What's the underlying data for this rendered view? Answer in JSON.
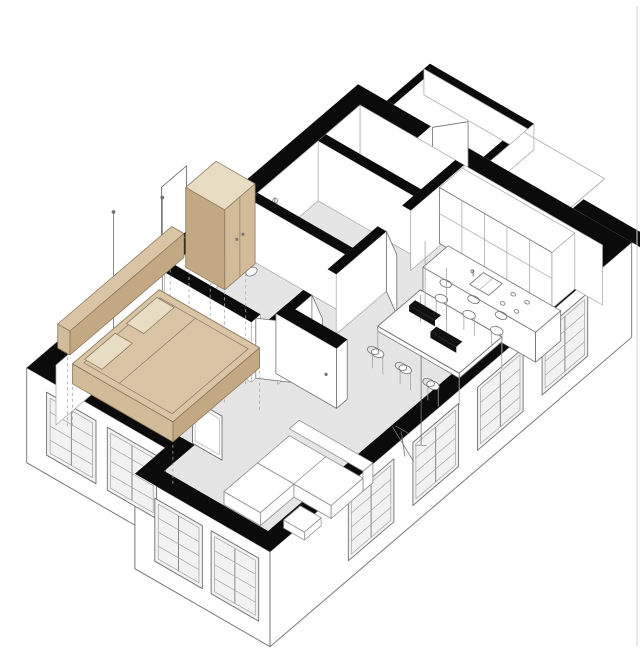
{
  "illustration": {
    "kind": "axonometric-floor-plan",
    "rooms": [
      "entry-hall",
      "bathroom",
      "wc",
      "bedroom",
      "kitchen",
      "dining-area",
      "living-area",
      "stair-annex"
    ],
    "elements": [
      "perimeter-walls",
      "interior-floor",
      "exterior-facades",
      "windows",
      "bed",
      "pillows",
      "headboard-shelf",
      "wardrobe",
      "glass-panel",
      "projection-lines",
      "kitchen-tall-cabinets",
      "kitchen-island",
      "sink",
      "cooktop",
      "faucet",
      "dining-table",
      "dining-chairs",
      "pendant-lights",
      "partition-wall",
      "tv-panel",
      "sofa",
      "coffee-table",
      "floor-lamp",
      "easel",
      "toilet",
      "shower",
      "door-leaves",
      "entrance-door"
    ],
    "dining_chair_count": 6,
    "pendant_count": 2,
    "window_count_se_facade": 4,
    "window_count_sw_facade": 2,
    "window_count_bay": 2
  },
  "colors": {
    "background": "#ffffff",
    "wall": "#0b0b0b",
    "floor": "#e5e5e6",
    "face": "#ffffff",
    "pane": "#f2f2f2",
    "outline": "#707070",
    "outline_light": "#a3a3a3",
    "dash": "#a8a8a8",
    "beige_top": "#d9c5a6",
    "beige_front": "#d2bb98",
    "beige_side": "#c2a984",
    "beige_light": "#e8dcc4",
    "beige_stroke": "#8d7a5f",
    "accent_black": "#111111",
    "hairline": "#cfcfcf"
  }
}
